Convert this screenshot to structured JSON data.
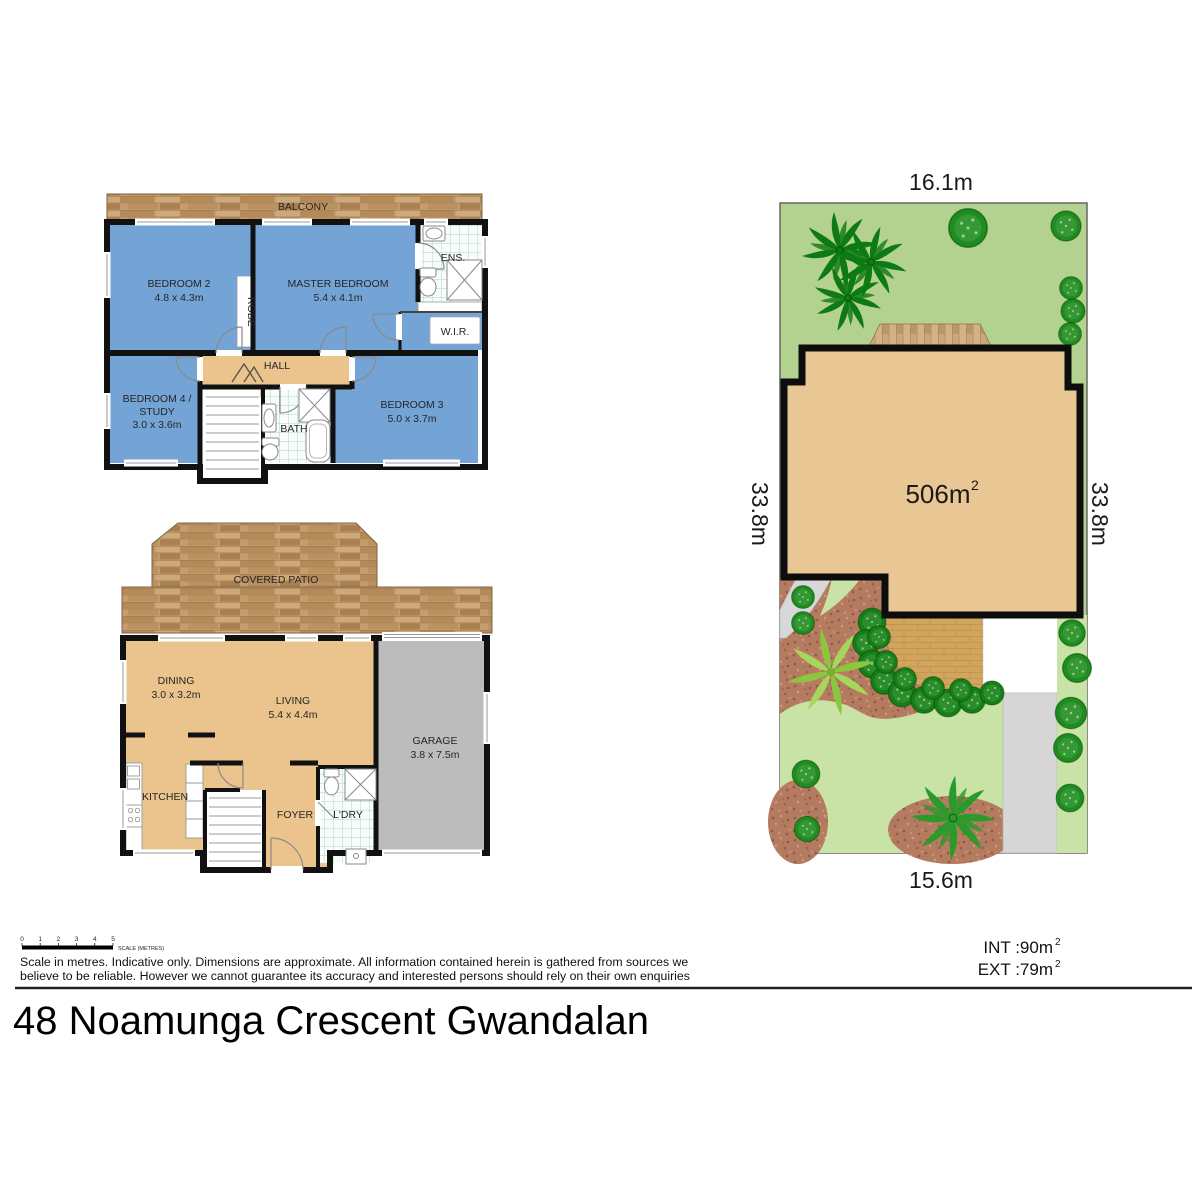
{
  "title": {
    "address": "48 Noamunga Crescent Gwandalan"
  },
  "footer": {
    "scale_ticks": [
      "0",
      "1",
      "2",
      "3",
      "4",
      "5"
    ],
    "scale_label": "SCALE (METRES)",
    "disclaimer1": "Scale in metres. Indicative only. Dimensions are approximate. All information contained herein is gathered from sources we",
    "disclaimer2": "believe to be reliable. However we cannot guarantee its accuracy and interested persons should rely on their own enquiries",
    "int_area": "INT :90m",
    "ext_area": "EXT :79m",
    "sup": "2"
  },
  "site": {
    "top_dim": "16.1m",
    "bottom_dim": "15.6m",
    "left_dim": "33.8m",
    "right_dim": "33.8m",
    "area": "506m",
    "area_sup": "2"
  },
  "upper": {
    "balcony": "BALCONY",
    "bedroom2_name": "BEDROOM 2",
    "bedroom2_dims": "4.8 x 4.3m",
    "master_name": "MASTER BEDROOM",
    "master_dims": "5.4 x 4.1m",
    "ens": "ENS.",
    "wir": "W.I.R.",
    "robe": "ROBE",
    "hall": "HALL",
    "bedroom4_name": "BEDROOM 4 /",
    "bedroom4_name2": "STUDY",
    "bedroom4_dims": "3.0 x 3.6m",
    "bath": "BATH",
    "bedroom3_name": "BEDROOM 3",
    "bedroom3_dims": "5.0 x 3.7m"
  },
  "ground": {
    "patio": "COVERED PATIO",
    "dining_name": "DINING",
    "dining_dims": "3.0 x 3.2m",
    "living_name": "LIVING",
    "living_dims": "5.4 x 4.4m",
    "garage_name": "GARAGE",
    "garage_dims": "3.8 x 7.5m",
    "kitchen": "KITCHEN",
    "foyer": "FOYER",
    "ldry": "L'DRY"
  },
  "colors": {
    "room_blue": "#74a3d6",
    "floor_tan": "#eac48c",
    "wall_black": "#111111",
    "lawn_green": "#b3d28f",
    "path_green": "#c9e2a6",
    "mulch_brown": "#b47b61",
    "garage_grey": "#bcbcbc",
    "house_tan": "#e8c795"
  }
}
